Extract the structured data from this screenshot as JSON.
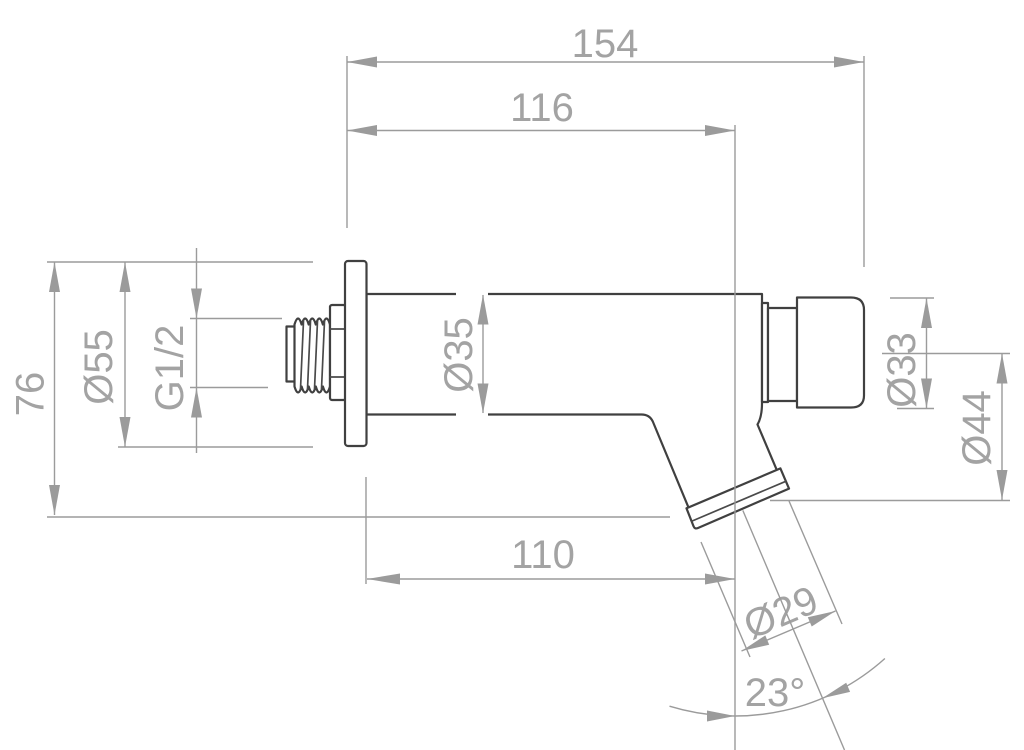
{
  "drawing": {
    "colors": {
      "outline": "#404040",
      "dimension_lines": "#9b9b9b",
      "label_text": "#a3a3a3",
      "background": "#ffffff"
    },
    "dimensions": {
      "overall_length": {
        "label": "154"
      },
      "wall_to_button": {
        "label": "116"
      },
      "overall_height": {
        "label": "76"
      },
      "flange_diameter": {
        "label": "Ø55"
      },
      "inlet_thread": {
        "label": "G1/2"
      },
      "body_diameter": {
        "label": "Ø35"
      },
      "button_diameter": {
        "label": "Ø33"
      },
      "outlet_face_diameter": {
        "label": "Ø44"
      },
      "wall_to_outlet": {
        "label": "110"
      },
      "spout_diameter": {
        "label": "Ø29"
      },
      "spout_angle": {
        "label": "23°"
      }
    }
  }
}
